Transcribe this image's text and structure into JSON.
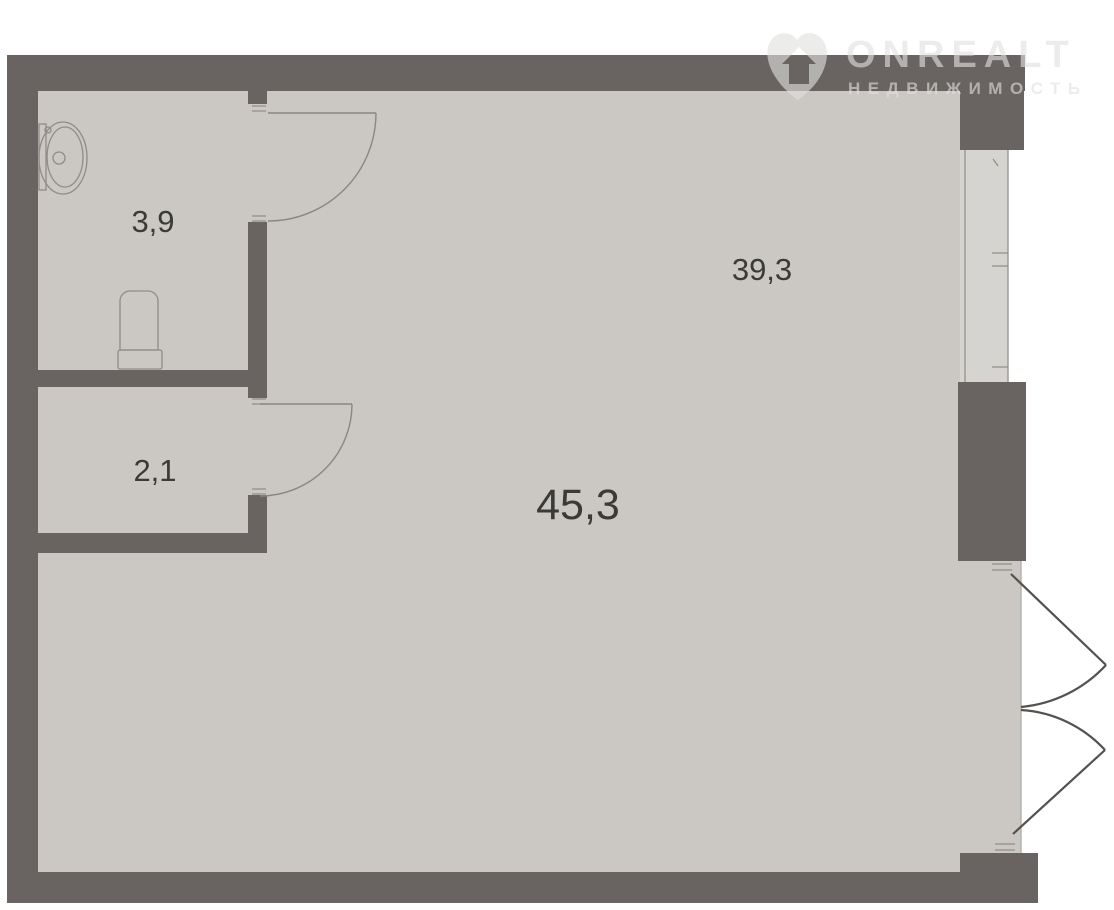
{
  "watermark": {
    "brand": "ONREALT",
    "subtitle": "НЕДВИЖИМОСТЬ"
  },
  "plan": {
    "type": "apartment-floor-plan",
    "labels": {
      "bathroom_area": "3,9",
      "hallway_area": "2,1",
      "living_area": "39,3",
      "total_area": "45,3"
    }
  },
  "colors": {
    "wall": "#696461",
    "floor": "#cbc8c3",
    "window_sill": "#d6d4d0",
    "fixture_line": "#8f8b85",
    "french_door_line": "#55514e",
    "label_text": "#3a3a38",
    "background": "#ffffff",
    "watermark": "#e1e0de"
  }
}
